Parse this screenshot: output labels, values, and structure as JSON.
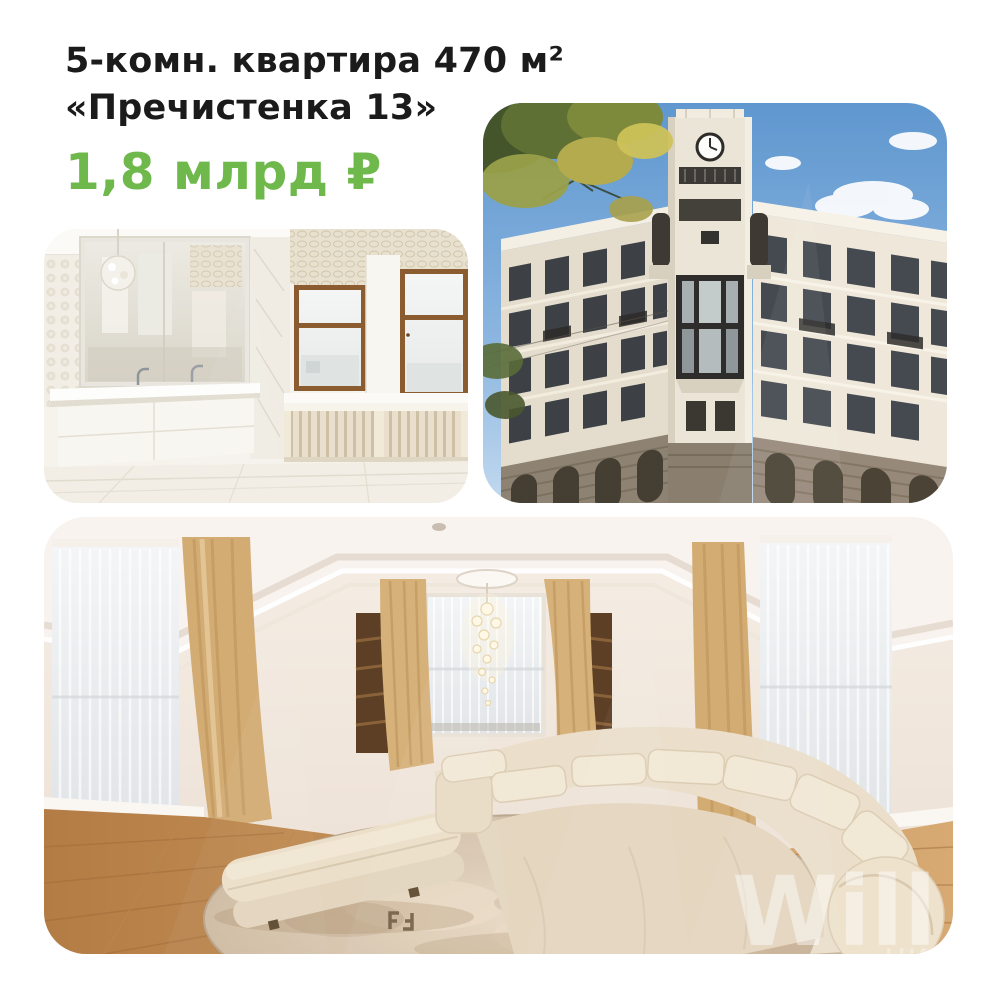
{
  "header": {
    "title_line1": "5-комн. квартира 470 м²",
    "title_line2": "«Пречистенка 13»",
    "price": "1,8 млрд ₽"
  },
  "colors": {
    "accent_green": "#6fb84c",
    "title_black": "#1b1b1b"
  },
  "photos": {
    "bathroom": {
      "name": "bathroom-interior-photo"
    },
    "building": {
      "name": "building-exterior-clock-tower-photo"
    },
    "living_room": {
      "name": "living-room-interior-photo",
      "watermark_primary": "Will",
      "watermark_secondary": "циал"
    }
  }
}
